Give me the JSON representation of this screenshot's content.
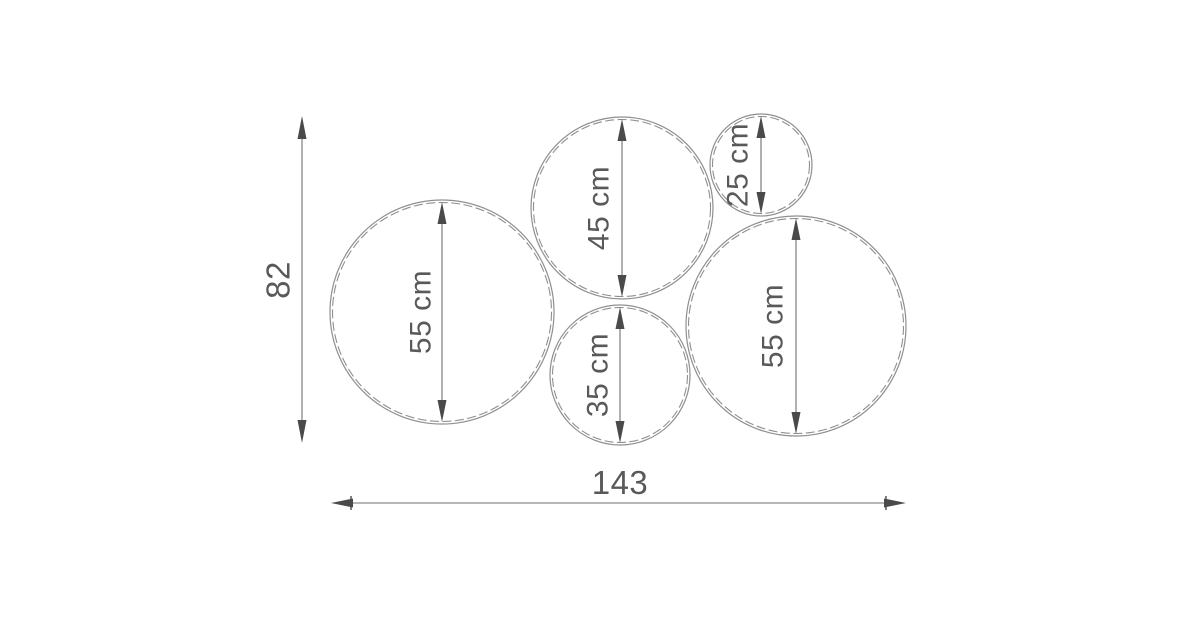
{
  "diagram": {
    "type": "dimensioned-drawing",
    "description": "Technical dimension drawing of five tangent circles (wall mirror set) with overall width and height dimensions",
    "overall_height_label": "82",
    "overall_width_label": "143",
    "circles": [
      {
        "name": "left-large-circle",
        "label": "55 cm",
        "diameter_cm": 55
      },
      {
        "name": "top-middle-circle",
        "label": "45 cm",
        "diameter_cm": 45
      },
      {
        "name": "top-right-small-circle",
        "label": "25 cm",
        "diameter_cm": 25
      },
      {
        "name": "bottom-middle-circle",
        "label": "35 cm",
        "diameter_cm": 35
      },
      {
        "name": "right-large-circle",
        "label": "55 cm",
        "diameter_cm": 55
      }
    ],
    "colors": {
      "background": "#ffffff",
      "outline": "#8f8f8f",
      "dimension_line": "#6f6f6f",
      "arrowhead": "#4a4a4a",
      "text": "#595959"
    }
  }
}
